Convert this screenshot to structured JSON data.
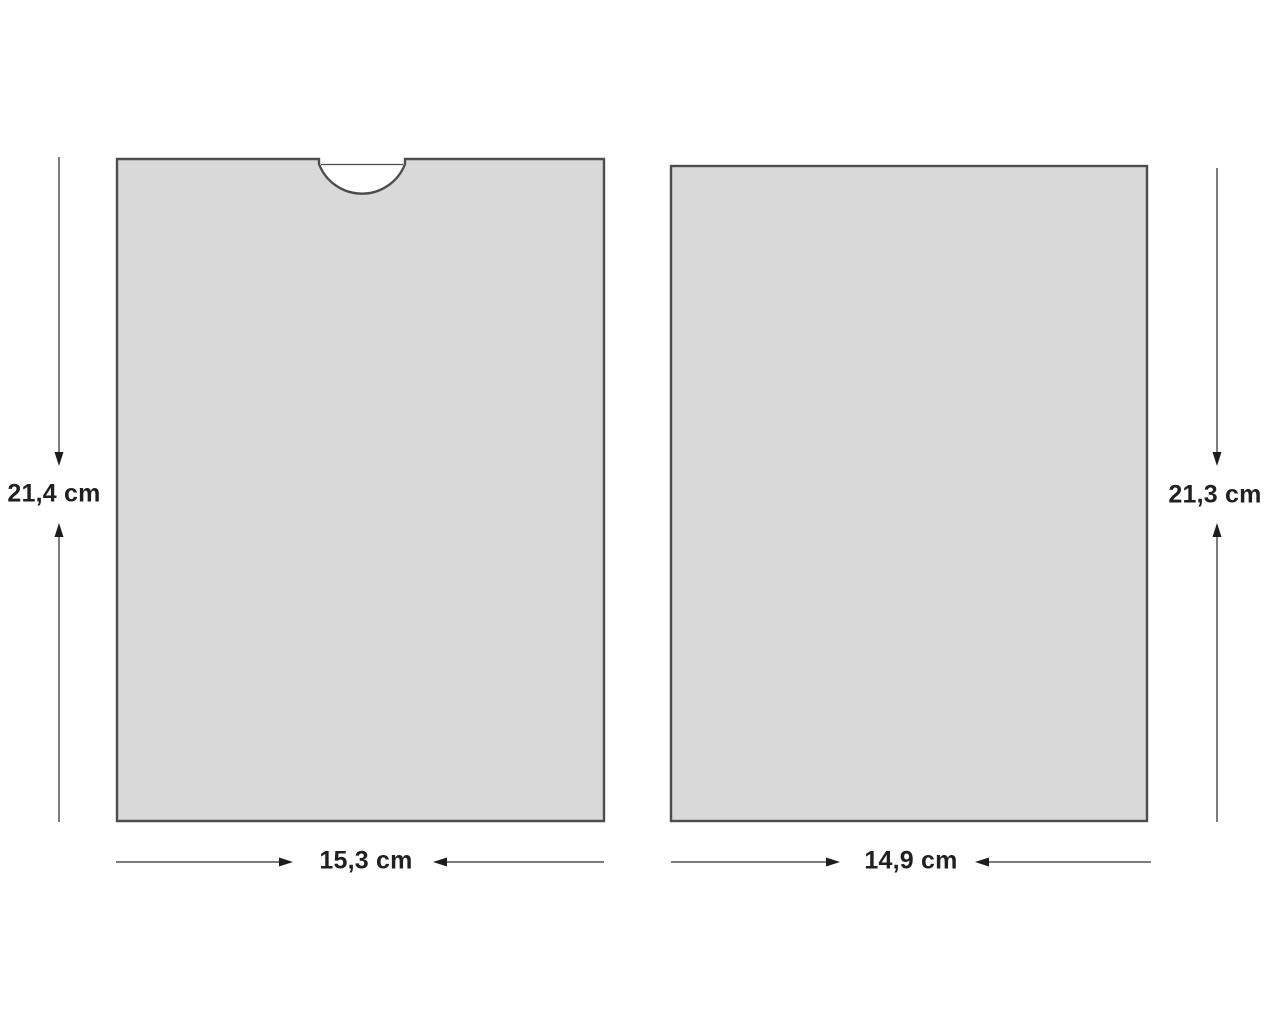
{
  "diagram": {
    "panels": [
      {
        "name": "sleeve-with-thumb-notch"
      },
      {
        "name": "insert-card"
      }
    ],
    "dimensions": {
      "sleeve_height": {
        "label": "21,4 cm"
      },
      "sleeve_width": {
        "label": "15,3 cm"
      },
      "card_height": {
        "label": "21,3 cm"
      },
      "card_width": {
        "label": "14,9 cm"
      }
    }
  },
  "colors": {
    "background": "#ffffff",
    "panel_fill": "#d9d9d9",
    "panel_stroke": "#4d4d4d",
    "dimension_line": "#7d7d7d",
    "arrowhead": "#1c1c1c",
    "label_text": "#221f20"
  }
}
